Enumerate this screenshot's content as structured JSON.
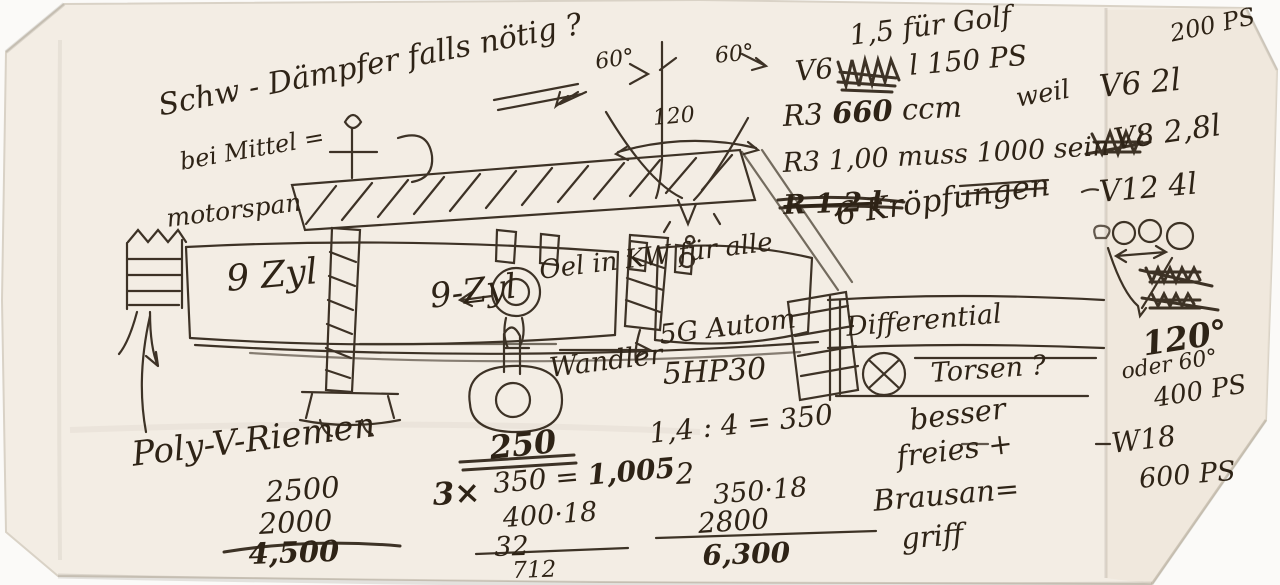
{
  "palette": {
    "ink": "#2e2316",
    "paper": "#f3ede4",
    "paper_flap": "#ece4d7",
    "scan_background": "#fbfaf8"
  },
  "notes": {
    "damper": "Schw - Dämpfer falls nötig ?",
    "angle60_left": "60°",
    "angle60_right": "60°",
    "angle120": "120",
    "golf": "1,5 für Golf",
    "v6_prefix": "V6",
    "v6_suffix": "l  150 PS",
    "r3_prefix": "R3",
    "r3_ccm_value": "660",
    "r3_ccm_unit": "ccm",
    "weil": "weil",
    "v6_2l": "V6 2l",
    "r3_muss_prefix": "R3 1,00 muss",
    "r3_muss_value": "1000",
    "r3_muss_suffix": "sein",
    "v8_28l": "V8 2,8l",
    "r_12l_struck": "R 1,2 l",
    "v12_4l": "V12 4l",
    "kroepfungen": "6 Kröpfungen",
    "ps_200": "200 PS",
    "bei_mittel": "bei Mittel =",
    "motorspan": "motorspan",
    "zyl_left": "9 Zyl",
    "zyl_right": "9-Zyl",
    "oel_kw": "Oel in KW für alle",
    "getriebe": "5G Autom",
    "wandler": "Wandler",
    "zf_code": "5HP30",
    "differential": "Differential",
    "torsen": "Torsen ?",
    "poly_v": "Poly-V-Riemen",
    "rpm_2500": "2500",
    "rpm_2000": "2000",
    "rpm_4500": "4,500",
    "t_250": "250",
    "mult_3x": "3×",
    "eq_350": "350 = ",
    "eq_1005": "1,005",
    "m_400_18": "400·18",
    "m_32": "32",
    "m_712": "712",
    "calc_14": "1,4 : 4 = 350",
    "small_2": "2",
    "m_350_18": "350·18",
    "m_2800": "2800",
    "m_6300": "6,300",
    "besser": "besser",
    "freies": "freies +",
    "brausan": "Brausan=",
    "griff": "griff",
    "deg_120": "120°",
    "oder_60": "oder 60°",
    "ps_400": "400 PS",
    "w18": "W18",
    "ps_600": "600 PS"
  }
}
